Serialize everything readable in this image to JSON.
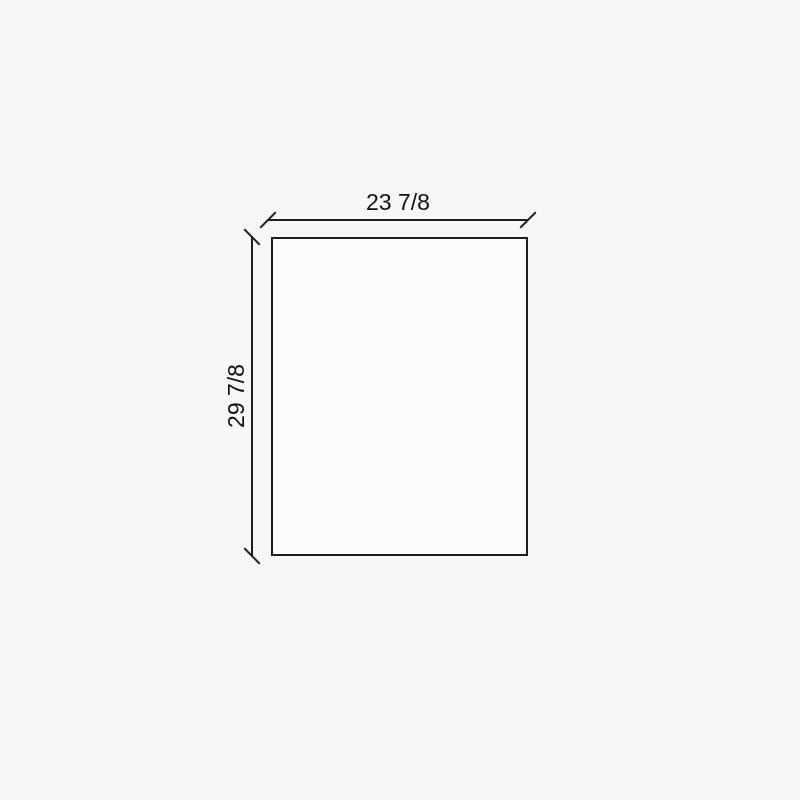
{
  "drawing": {
    "type": "dimension-diagram",
    "shape": "rectangle",
    "width_dimension_label": "23 7/8",
    "height_dimension_label": "29 7/8"
  },
  "colors": {
    "background": "#f7f7f7",
    "panel_fill": "#fcfcfc",
    "line": "#1e1e1e",
    "text": "#111111"
  }
}
